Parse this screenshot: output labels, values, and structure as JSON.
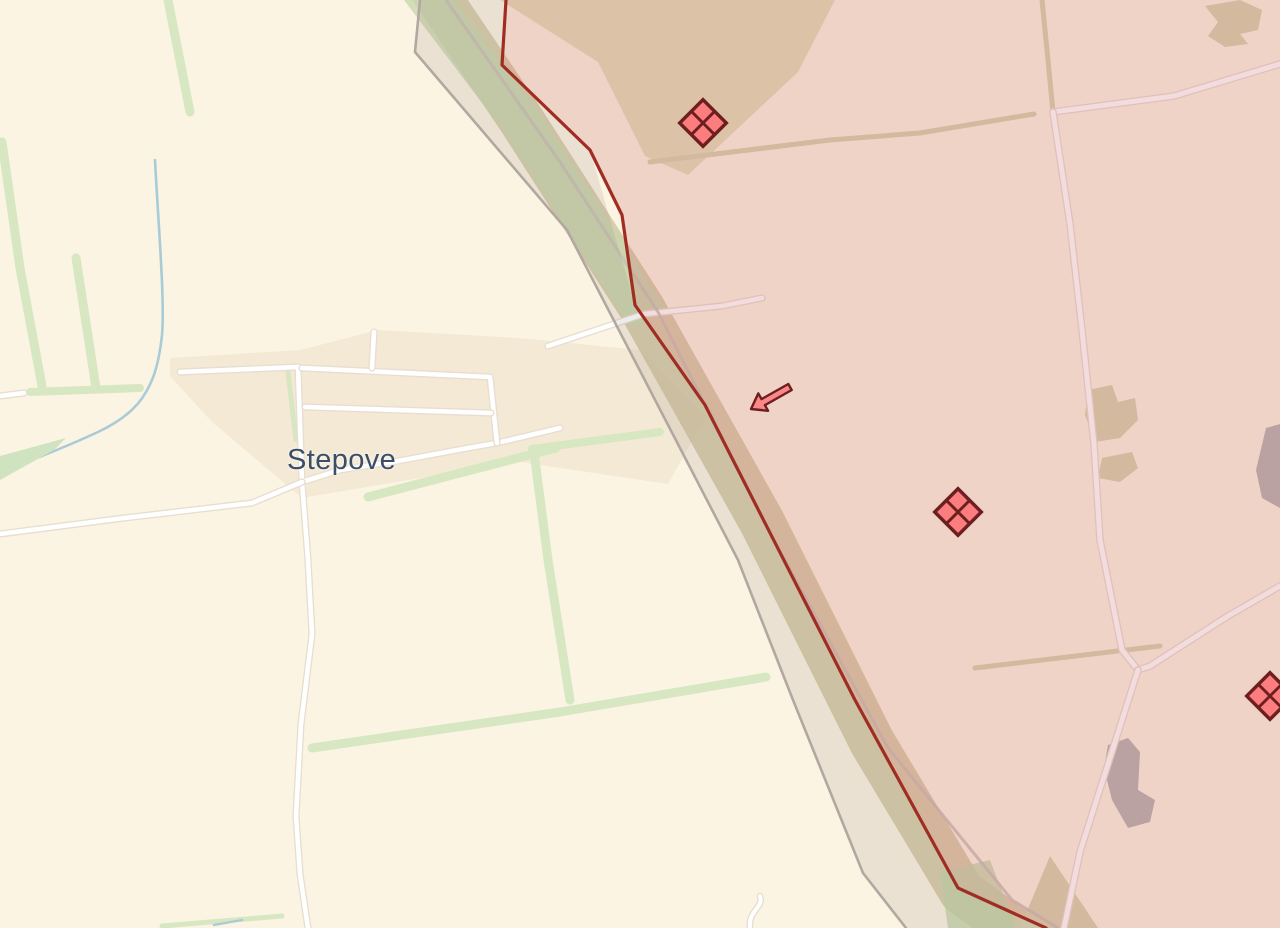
{
  "map": {
    "place_label": "Stepove",
    "colors": {
      "background_cream": "#fcf4e2",
      "village_fill": "#f4e9d4",
      "treeline_green": "#d7e7c2",
      "stream_blue": "#a9cbd7",
      "road_white": "#ffffff",
      "road_casing": "#e7ddd0",
      "field_track_tan": "#d8d2ac",
      "dirt_road_gray": "#c8beb6",
      "grey_zone_fill": "rgba(138,122,122,0.15)",
      "grey_zone_line": "#b2a8a1",
      "occupied_fill": "rgba(196,94,104,0.22)",
      "frontline_red": "#a02d23",
      "unit_marker_fill": "#fb7d7d",
      "unit_marker_stroke": "#6d1f1f",
      "label_color": "#3c4d66"
    },
    "features": [
      {
        "name": "village-area",
        "kind": "polygon",
        "points": "170,358 300,350 378,330 520,338 640,350 706,416 668,484 520,462 420,478 302,498 212,422 170,376",
        "fill": "#f4e9d4"
      },
      {
        "name": "field-olive-top",
        "kind": "polygon",
        "points": "500,0 835,0 798,72 688,175 645,156 598,62",
        "fill": "#e2dcb6",
        "opacity": "0.95"
      },
      {
        "name": "treeline-corridor-band",
        "kind": "path",
        "d": "M 432,-12 L 520,118 L 642,308 L 762,522 L 872,742 L 962,892 L 1025,938",
        "stroke": "#cfc49e",
        "sw": 46,
        "opacity": "0.8",
        "cap": "butt"
      },
      {
        "name": "treeline-corridor-green-top",
        "kind": "path",
        "d": "M 420,-12 L 520,120 L 648,318",
        "stroke": "#c8d7ae",
        "sw": 40,
        "opacity": "0.8",
        "cap": "butt"
      },
      {
        "name": "tan-patch-topright",
        "kind": "polygon",
        "points": "1205,6 1240,0 1262,10 1258,30 1240,34 1248,44 1225,47 1208,36 1218,22",
        "fill": "#d8d2ac"
      },
      {
        "name": "tan-patch-mid-1",
        "kind": "polygon",
        "points": "1088,390 1112,385 1118,402 1135,398 1138,420 1120,438 1095,442 1085,415",
        "fill": "#d8d2ac"
      },
      {
        "name": "tan-patch-mid-2",
        "kind": "polygon",
        "points": "1102,458 1132,452 1138,468 1120,482 1098,478",
        "fill": "#d8d2ac"
      },
      {
        "name": "field-bottom-tan",
        "kind": "polygon",
        "points": "1020,928 1050,856 1098,928",
        "fill": "#d8d2ae"
      },
      {
        "name": "green-strip-bottom",
        "kind": "polygon",
        "points": "940,872 990,860 1016,928 948,928",
        "fill": "#c2d4a8",
        "opacity": "0.75"
      },
      {
        "name": "quarry-gray",
        "kind": "polygon",
        "points": "1108,745 1128,738 1140,752 1138,790 1155,800 1150,822 1128,828 1112,800 1104,768",
        "fill": "#b8b4b2"
      },
      {
        "name": "gray-patch-right-edge",
        "kind": "polygon",
        "points": "1266,428 1280,424 1280,508 1262,498 1256,470",
        "fill": "#b8b4b2"
      },
      {
        "name": "treeline-1",
        "kind": "path",
        "d": "M 168,0 L 190,112",
        "stroke": "#d7e7c2",
        "sw": 9
      },
      {
        "name": "treeline-2",
        "kind": "path",
        "d": "M 2,142 L 20,268 L 42,386",
        "stroke": "#d7e7c2",
        "sw": 9
      },
      {
        "name": "treeline-3",
        "kind": "path",
        "d": "M 76,258 L 96,388",
        "stroke": "#d7e7c2",
        "sw": 9
      },
      {
        "name": "treeline-4",
        "kind": "path",
        "d": "M 30,392 L 140,388",
        "stroke": "#d7e7c2",
        "sw": 8
      },
      {
        "name": "treeline-5",
        "kind": "path",
        "d": "M 288,372 L 296,440",
        "stroke": "#d7e7c2",
        "sw": 5
      },
      {
        "name": "treeline-6",
        "kind": "path",
        "d": "M 368,497 L 556,448",
        "stroke": "#d7e7c2",
        "sw": 9
      },
      {
        "name": "treeline-7",
        "kind": "path",
        "d": "M 534,452 L 548,560 L 570,700",
        "stroke": "#d7e7c2",
        "sw": 9
      },
      {
        "name": "treeline-8",
        "kind": "path",
        "d": "M 312,748 L 560,712 L 766,677",
        "stroke": "#d7e7c2",
        "sw": 9
      },
      {
        "name": "treeline-9",
        "kind": "path",
        "d": "M 532,449 L 660,432",
        "stroke": "#d7e7c2",
        "sw": 8
      },
      {
        "name": "treeline-bottom-edge",
        "kind": "path",
        "d": "M 162,926 L 282,916",
        "stroke": "#d7e7c2",
        "sw": 5
      },
      {
        "name": "stream",
        "kind": "path",
        "d": "M 155,160 C 158,220 165,300 162,335 C 158,372 150,385 146,392 C 135,412 115,424 98,432 C 70,445 38,458 0,472",
        "stroke": "#a9cbd7",
        "sw": 2.6
      },
      {
        "name": "stream-bottom-edge",
        "kind": "path",
        "d": "M 214,925 L 242,920",
        "stroke": "#a9cbd7",
        "sw": 2.4
      },
      {
        "name": "pond-wedge",
        "kind": "polygon",
        "points": "0,456 66,438 54,450 0,480",
        "fill": "#cfe3c0"
      },
      {
        "name": "field-track-1",
        "kind": "path",
        "d": "M 650,162 L 830,140 L 920,133 L 1034,114",
        "stroke": "#d8d2ac",
        "sw": 5
      },
      {
        "name": "field-track-2",
        "kind": "path",
        "d": "M 1042,0 L 1048,60 L 1053,112",
        "stroke": "#d8d2ac",
        "sw": 5
      },
      {
        "name": "field-track-3",
        "kind": "path",
        "d": "M 975,668 L 1160,646",
        "stroke": "#d8d2ac",
        "sw": 5
      },
      {
        "name": "road-stub-left",
        "kind": "path",
        "d": "M 0,396 L 24,393",
        "stroke": "#ffffff",
        "sw": 4.6,
        "casing": "#e7ddd0"
      },
      {
        "name": "road-main-village",
        "kind": "path",
        "d": "M 180,372 L 298,367 L 302,482 L 340,470 L 398,461 L 468,448 L 497,443 L 560,428",
        "stroke": "#ffffff",
        "sw": 4.6,
        "casing": "#e7ddd0"
      },
      {
        "name": "road-south",
        "kind": "path",
        "d": "M 302,482 L 308,560 L 312,634 L 301,724 L 296,816 L 300,874 L 308,928",
        "stroke": "#ffffff",
        "sw": 4.6,
        "casing": "#e7ddd0"
      },
      {
        "name": "road-southwest-diagonal",
        "kind": "path",
        "d": "M 0,534 L 124,518 L 252,503 L 302,482",
        "stroke": "#ffffff",
        "sw": 4.6,
        "casing": "#e7ddd0"
      },
      {
        "name": "road-ladder-top",
        "kind": "path",
        "d": "M 302,368 L 490,377 L 497,443",
        "stroke": "#ffffff",
        "sw": 4.6,
        "casing": "#e7ddd0"
      },
      {
        "name": "road-ladder-middle",
        "kind": "path",
        "d": "M 305,407 L 491,413",
        "stroke": "#ffffff",
        "sw": 4.6,
        "casing": "#e7ddd0"
      },
      {
        "name": "road-ladder-stub",
        "kind": "path",
        "d": "M 374,332 L 372,368",
        "stroke": "#ffffff",
        "sw": 4.6,
        "casing": "#e7ddd0"
      },
      {
        "name": "road-front-crossing",
        "kind": "path",
        "d": "M 548,346 L 644,314 L 722,306 L 762,298",
        "stroke": "#ffffff",
        "sw": 4.6,
        "casing": "#e7ddd0"
      },
      {
        "name": "road-east-west",
        "kind": "path",
        "d": "M 1053,112 L 1174,96 L 1280,64",
        "stroke": "#ffffff",
        "sw": 5,
        "casing": "#e7ddd0"
      },
      {
        "name": "road-north-south-east",
        "kind": "path",
        "d": "M 1053,112 L 1070,224 L 1082,330 L 1094,444 L 1100,540 L 1122,650 L 1138,670",
        "stroke": "#ffffff",
        "sw": 5,
        "casing": "#e7ddd0"
      },
      {
        "name": "road-from-right-edge",
        "kind": "path",
        "d": "M 1280,586 L 1228,616 L 1150,666 L 1138,670",
        "stroke": "#ffffff",
        "sw": 5,
        "casing": "#e7ddd0"
      },
      {
        "name": "road-to-bottom",
        "kind": "path",
        "d": "M 1138,670 L 1108,764 L 1080,852 L 1064,928",
        "stroke": "#ffffff",
        "sw": 5,
        "casing": "#e7ddd0"
      },
      {
        "name": "road-bottom-wiggle",
        "kind": "path",
        "d": "M 750,928 C 748,910 764,908 760,896",
        "stroke": "#ffffff",
        "sw": 4,
        "casing": "#e7ddd0"
      },
      {
        "name": "dirt-road-corridor",
        "kind": "path",
        "d": "M 446,0 L 560,162 L 658,312 L 775,542 L 888,748 L 1012,900 L 1058,928",
        "stroke": "#c8beb6",
        "sw": 3,
        "opacity": "0.85"
      },
      {
        "name": "grey-zone",
        "kind": "polygon",
        "points": "420,0 415,52 567,230 738,560 793,700 863,873 906,928 1046,928 958,888 855,700 705,405 635,305 590,150 502,65 506,0",
        "fill": "rgba(138,122,122,0.15)"
      },
      {
        "name": "grey-zone-boundary",
        "kind": "path",
        "d": "M 420,0 L 415,52 L 567,230 L 738,560 L 793,700 L 863,873 L 906,928",
        "stroke": "#b2a8a1",
        "sw": 2.6
      },
      {
        "name": "occupied-zone",
        "kind": "polygon",
        "points": "506,0 502,65 590,150 622,215 635,305 705,405 855,700 958,888 1046,928 1280,928 1280,0",
        "fill": "rgba(196,94,104,0.22)"
      },
      {
        "name": "frontline",
        "kind": "path",
        "d": "M 506,0 L 502,65 L 590,150 L 622,215 L 635,305 L 705,405 L 855,700 L 958,888 L 1046,928",
        "stroke": "#a02d23",
        "sw": 3.2
      }
    ],
    "markers": {
      "units": [
        {
          "name": "unit-marker-1",
          "x": 703,
          "y": 123
        },
        {
          "name": "unit-marker-2",
          "x": 958,
          "y": 512
        },
        {
          "name": "unit-marker-3",
          "x": 1270,
          "y": 696
        }
      ],
      "unit_style": {
        "half_side": 16.5,
        "fill": "#fb7d7d",
        "stroke": "#6d1f1f",
        "sw": 3.4
      },
      "arrow": {
        "name": "attack-arrow",
        "points": "788.3,384 761.5,399.1 758.3,393.4 751,409 768.1,410.8 764.9,405.2 791.7,390",
        "fill": "#fb8888",
        "stroke": "#6d1f1f",
        "sw": 2.4
      }
    }
  }
}
